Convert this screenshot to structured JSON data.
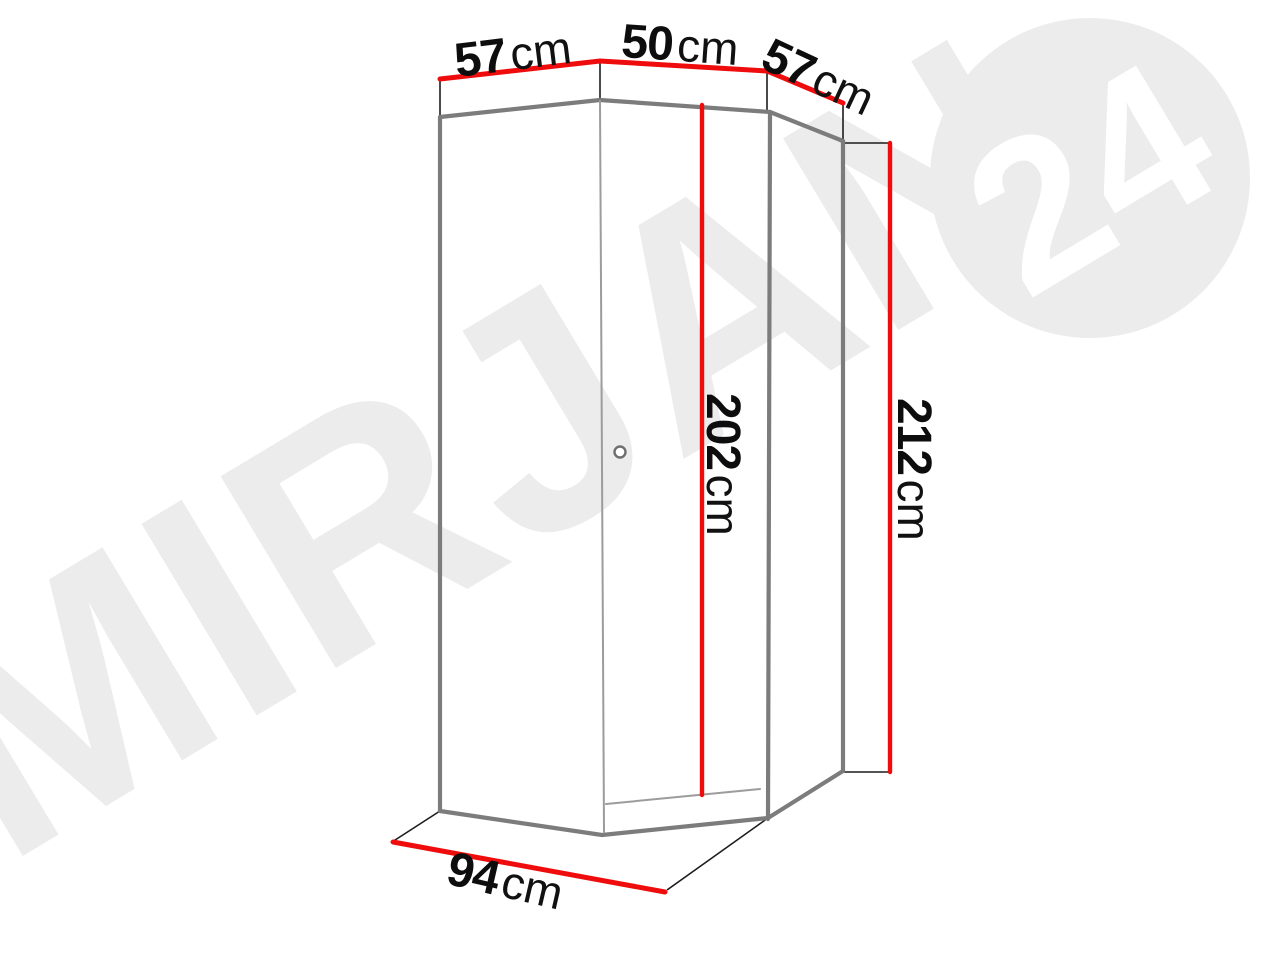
{
  "watermark": {
    "brand_text": "MIRJAN",
    "badge_text": "24",
    "text_color": "#ececec",
    "badge_bg_color": "#ececec",
    "badge_text_color": "#ffffff"
  },
  "dimensions": {
    "top_left_width": {
      "value": "57",
      "unit": "cm"
    },
    "top_center_width": {
      "value": "50",
      "unit": "cm"
    },
    "top_right_width": {
      "value": "57",
      "unit": "cm"
    },
    "front_height": {
      "value": "202",
      "unit": "cm"
    },
    "side_height": {
      "value": "212",
      "unit": "cm"
    },
    "base_width": {
      "value": "94",
      "unit": "cm"
    }
  },
  "colors": {
    "dimension_line": "#ee0c0c",
    "body_outline": "#7c7c7c",
    "extension_line": "#1c1c1c",
    "label_text": "#0d0d0d"
  }
}
